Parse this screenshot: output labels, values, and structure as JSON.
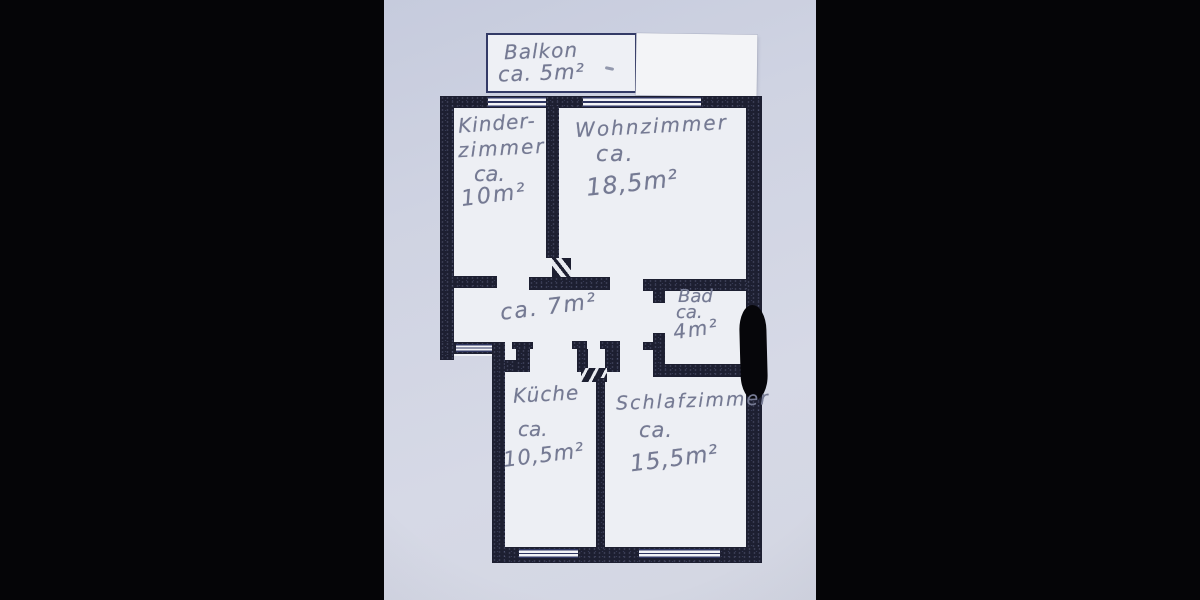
{
  "document_type_label": "hand-annotated apartment floor plan photo",
  "colors": {
    "paper": "#d2d6e4",
    "wall": "#1d1f31",
    "thin_line": "#2e3560",
    "pencil": "#757a93",
    "interior": "#edeff4",
    "redaction_marker": "#06060a",
    "backdrop": "#050507"
  },
  "rooms": {
    "balkon": {
      "name": "Balkon",
      "area": "ca. 5m²"
    },
    "kinderzimmer": {
      "name_line1": "Kinder-",
      "name_line2": "zimmer",
      "approx": "ca.",
      "area": "10m²"
    },
    "wohnzimmer": {
      "name": "Wohnzimmer",
      "approx": "ca.",
      "area": "18,5m²"
    },
    "flur": {
      "area": "ca. 7m²"
    },
    "bad": {
      "name": "Bad",
      "approx": "ca.",
      "area": "4m²"
    },
    "kueche": {
      "name": "Küche",
      "approx": "ca.",
      "area": "10,5m²"
    },
    "schlafzimmer": {
      "name": "Schlafzimmer",
      "approx": "ca.",
      "area": "15,5m²"
    }
  }
}
